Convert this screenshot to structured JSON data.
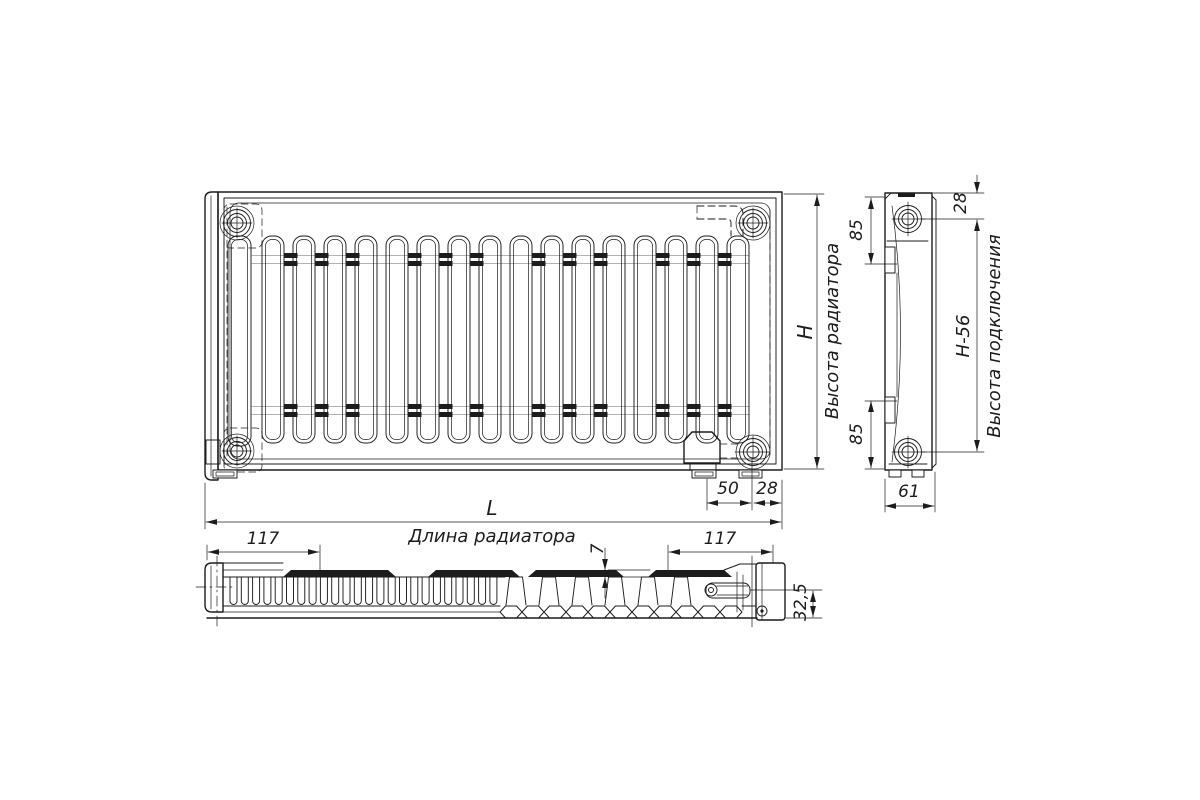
{
  "colors": {
    "background": "#ffffff",
    "line": "#1c1c1c"
  },
  "dimensions": {
    "radiator_height": {
      "symbol": "H",
      "label": "Высота радиатора"
    },
    "connection_height": {
      "value": "H-56",
      "label": "Высота подключения"
    },
    "radiator_length": {
      "symbol": "L",
      "label": "Длина радиатора"
    },
    "side_top_to_port_axis": "28",
    "side_top_port_inset": "85",
    "side_bottom_port_inset": "85",
    "side_depth": "61",
    "bracket_to_port_axis": "50",
    "port_axis_to_edge": "28",
    "bracket_offset_left": "117",
    "bracket_offset_right": "117",
    "panel_top_plate_thickness": "7",
    "pipe_axis_to_bottom": "32,5"
  }
}
